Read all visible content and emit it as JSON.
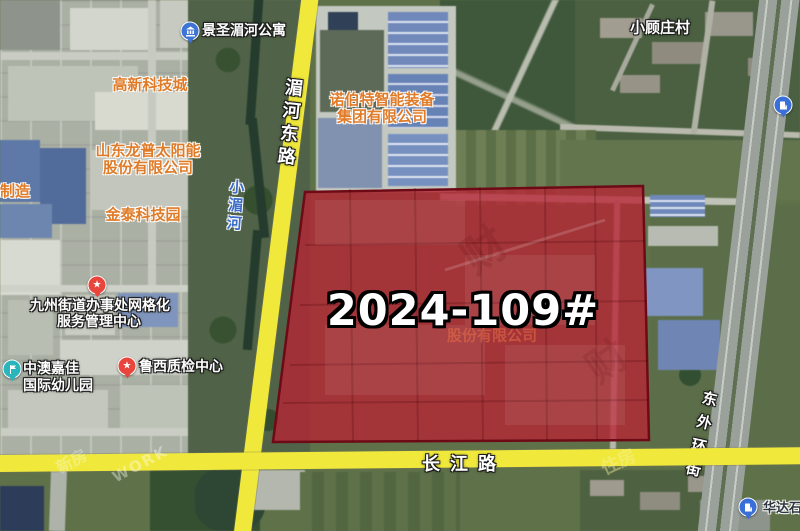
{
  "parcel": {
    "code": "2024-109#",
    "company_hint": "股份有限公司"
  },
  "roads": {
    "meihe_east": "湄河东路",
    "changjiang": "长江路",
    "east_ring": "东外环街",
    "xiaomei_river": "小湄河"
  },
  "pois": {
    "jingsheng_apartment": {
      "name": "景圣湄河公寓",
      "icon": "building-pin"
    },
    "gaoxin_tech_city": {
      "name": "高新科技城"
    },
    "longpu_solar_line1": {
      "name": "山东龙普太阳能"
    },
    "longpu_solar_line2": {
      "name": "股份有限公司"
    },
    "jintai_tech_park": {
      "name": "金泰科技园"
    },
    "zhizao_partial": {
      "name": "制造"
    },
    "nuobote_line1": {
      "name": "诺伯特智能装备"
    },
    "nuobote_line2": {
      "name": "集团有限公司"
    },
    "xiaoguzhuang_village": {
      "name": "小顾庄村"
    },
    "jiuzhou_center_line1": {
      "name": "九州街道办事处网格化"
    },
    "jiuzhou_center_line2": {
      "name": "服务管理中心"
    },
    "zhongao_kindergarten_line1": {
      "name": "中澳嘉佳"
    },
    "zhongao_kindergarten_line2": {
      "name": "国际幼儿园"
    },
    "luxi_quality_center": {
      "name": "鲁西质检中心"
    },
    "huada_gas": {
      "name": "华达石",
      "icon": "gas-pin"
    }
  },
  "watermarks": {
    "w_work": "WORK",
    "w_zhufang": "住房",
    "w_xinfang": "新房",
    "w_seal_a": "财",
    "w_seal_b": "财"
  },
  "colors": {
    "parcel_fill": "#b22636",
    "parcel_border": "#6e0a16",
    "road_yellow": "#f0e93c",
    "label_orange": "#e07b28",
    "river_blue": "#3a6cc8",
    "pin_blue": "#3e74d6",
    "pin_red": "#e8453c",
    "pin_teal": "#2ab5bd"
  }
}
